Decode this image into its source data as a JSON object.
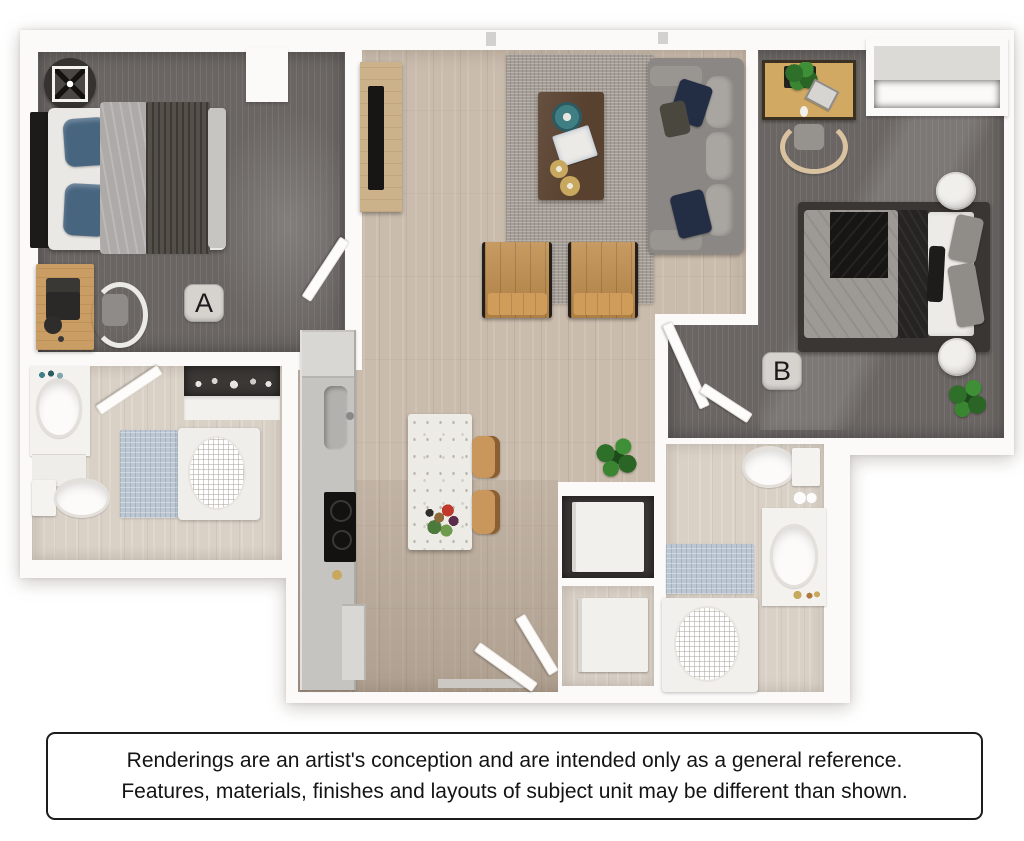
{
  "floorplan": {
    "unit_labels": {
      "bedroom_a": "A",
      "bedroom_b": "B"
    },
    "colors": {
      "carpet_dark": "#6b6663",
      "wood_floor": "#cabcad",
      "bath_floor": "#d9d0c6",
      "wall_white": "#fbfaf8",
      "rug_gray": "#a49d95",
      "accent_chair_tan": "#c08d4c",
      "pillow_navy": "#232e44",
      "pillow_blue": "#47657f",
      "bath_mat_blue": "#b9c6d4",
      "plant_green": "#38812f",
      "desk_wood": "#d1a963",
      "coffee_table_brown": "#59412f",
      "badge_gray": "#d6d3cf"
    },
    "rooms": [
      {
        "name": "bedroom-a",
        "label": "A",
        "items": [
          "ceiling-fan",
          "bed",
          "desk",
          "laptop",
          "desk-chair",
          "door"
        ]
      },
      {
        "name": "living-room",
        "items": [
          "tv-console",
          "tv",
          "area-rug",
          "coffee-table",
          "sofa",
          "accent-chair",
          "accent-chair",
          "floor-plant"
        ]
      },
      {
        "name": "kitchen",
        "items": [
          "refrigerator",
          "counter",
          "sink",
          "cooktop",
          "island",
          "barstool",
          "barstool"
        ]
      },
      {
        "name": "bedroom-b",
        "label": "B",
        "items": [
          "desk",
          "desk-chair",
          "closet",
          "bed",
          "nightstand",
          "nightstand",
          "plant",
          "door"
        ]
      },
      {
        "name": "bathroom-a",
        "items": [
          "vanity-sink",
          "toilet",
          "bath-mat",
          "tub-shower",
          "linen-closet",
          "door"
        ]
      },
      {
        "name": "bathroom-b",
        "items": [
          "toilet",
          "vanity-sink",
          "bath-mat",
          "shower"
        ]
      },
      {
        "name": "laundry-closet",
        "items": [
          "washer",
          "dryer"
        ]
      },
      {
        "name": "entry",
        "items": [
          "entry-door",
          "entry-door"
        ]
      }
    ]
  },
  "disclaimer": {
    "line1": "Renderings are an artist's conception and are intended only as a general reference.",
    "line2": "Features, materials, finishes and layouts of subject unit may be different than shown."
  }
}
